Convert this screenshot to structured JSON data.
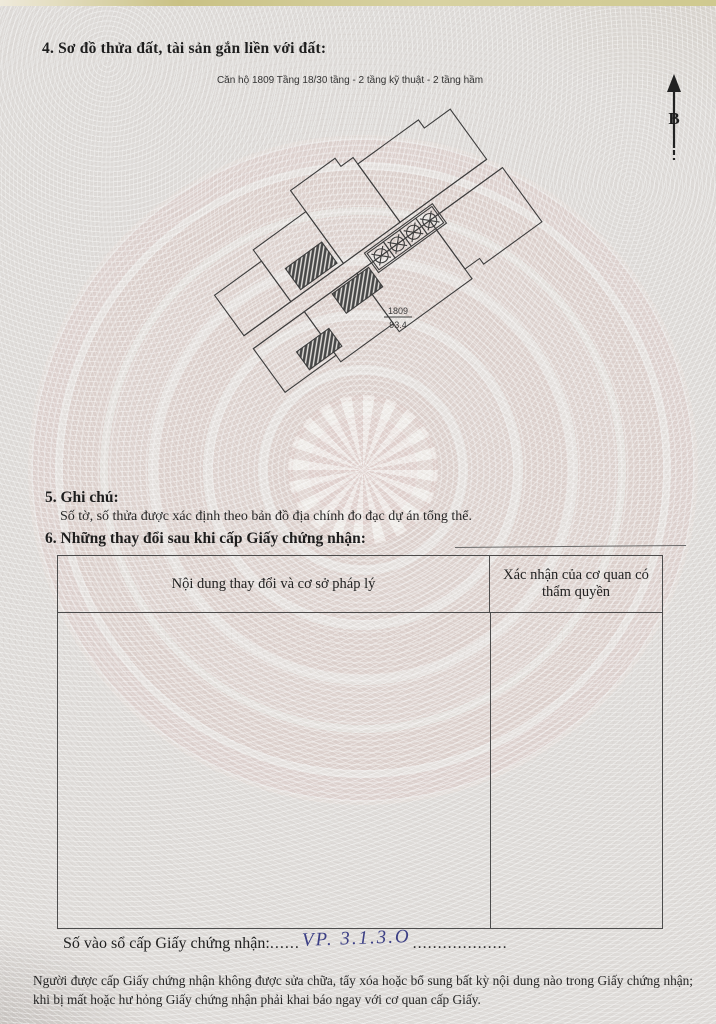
{
  "document": {
    "section4_heading": "4. Sơ đồ thửa đất, tài sản gắn liền với đất:",
    "plan_caption": "Căn hộ 1809 Tầng 18/30 tầng - 2 tầng kỹ thuật - 2 tầng hầm",
    "north_label": "B",
    "plan_label": {
      "unit": "1809",
      "area": "93.4"
    },
    "section5_heading": "5. Ghi chú:",
    "section5_note": "Số tờ, số thửa được xác định theo bản đồ địa chính đo đạc dự án tổng thể.",
    "section6_heading": "6. Những thay đổi sau khi cấp Giấy chứng nhận:",
    "table": {
      "header_col1": "Nội dung thay đổi và cơ sở pháp lý",
      "header_col2": "Xác nhận của cơ quan có thẩm quyền"
    },
    "registry_label": "Số vào sổ cấp Giấy chứng nhận:",
    "registry_dots_left": "......",
    "registry_value": "VP. 3.1.3.O",
    "registry_dots_right": "...................",
    "footer_note": "Người được cấp Giấy chứng nhận không được sửa chữa, tẩy xóa hoặc bổ sung bất kỳ nội dung nào trong Giấy chứng nhận; khi bị mất hoặc hư hỏng Giấy chứng nhận phải khai báo ngay với cơ quan cấp Giấy."
  },
  "colors": {
    "paper": "#dedbd8",
    "drum_ring_pink": "#dccac6",
    "ink": "#1d1d1d",
    "handwriting_blue": "#3c3f85",
    "plan_line": "#3d3d3d"
  }
}
